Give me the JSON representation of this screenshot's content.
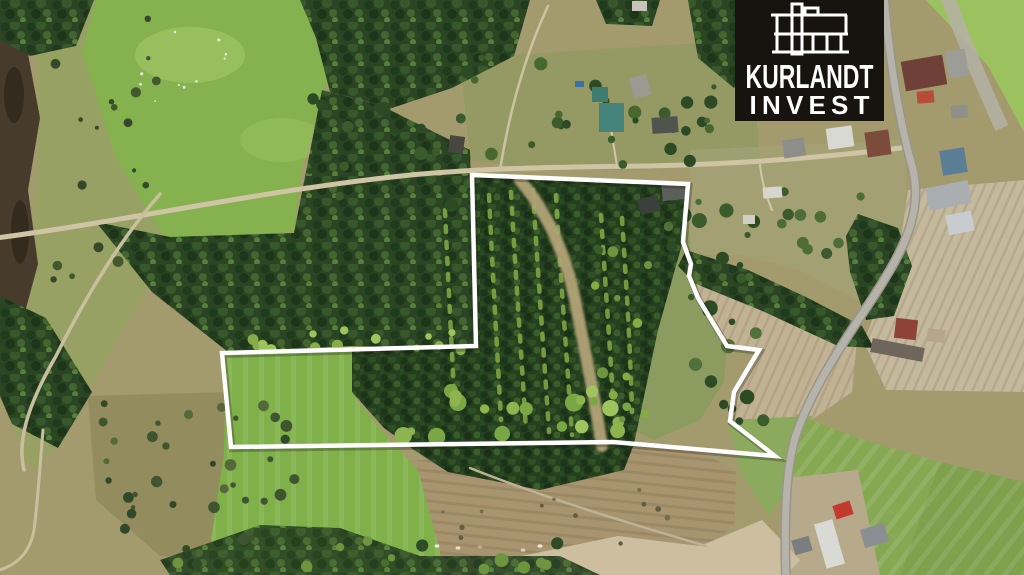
{
  "logo": {
    "brand_line1": "KURLANDT",
    "brand_line2": "INVEST",
    "bg": "#17140f",
    "fg": "#ffffff",
    "icon": "building-icon"
  },
  "boundary": {
    "color": "#ffffff",
    "stroke_width": 4.5,
    "points": "472,175 688,184 683,242 691,264 689,276 698,298 727,346 759,350 734,392 730,421 775,456 613,442 231,447 222,353 476,346"
  },
  "scene": {
    "colors": {
      "base_scrub": "#a39b6e",
      "marsh": "#98a164",
      "water": "#473c2b",
      "meadow": "#85b14e",
      "field_green_left": "#7fb04a",
      "field_green_right": "#87a853",
      "field_green_tr": "#9cc25f",
      "plow_beige": "#c4b89d",
      "plow_beige2": "#c1b294",
      "brown_field": "#a8956f",
      "beige_subfield": "#ccbe9f",
      "olive_meadow": "#8c9b5f",
      "grass_patch": "#8caa5e",
      "farm_yard": "#b7aa8a",
      "road_paved": "#b6b3ab",
      "road_paved_edge": "#999589",
      "road_dirt": "#cfc5a5",
      "clearing": "#b2a377",
      "forest_dark": "#2b4524",
      "plantation": "#25401e",
      "row_green": "#85ab45"
    },
    "roads": {
      "paved": "M884,-4 C889,55 897,112 912,166 C923,206 907,243 884,280 C858,323 818,374 797,432 C786,463 784,520 786,578",
      "dirt_main": "M-4,238 C120,222 250,193 392,177 C470,168 560,167 648,166 C740,164 830,157 908,147",
      "north_path": "M500,170 C508,120 522,62 548,6",
      "drive_teal": "M617,166 C613,142 610,122 607,104",
      "yard_path": "M760,165 C762,185 768,200 772,210",
      "forest_path": "M160,194 C118,242 84,300 56,356 C42,380 34,398 28,416 C22,436 20,452 24,470",
      "left_path": "M43,430 C40,465 38,500 34,530 C30,552 18,564 0,570",
      "field_path": "M470,468 C545,498 625,522 706,546",
      "clearing": "M520,180 C545,210 565,250 575,300 C583,340 595,400 602,446",
      "plow_band_tr": "M947,-4 C960,30 980,80 1002,128"
    },
    "houses": [
      {
        "x": 652,
        "y": 117,
        "w": 26,
        "h": 16,
        "r": -4,
        "f": "#4f544f"
      },
      {
        "x": 783,
        "y": 139,
        "w": 22,
        "h": 18,
        "r": -8,
        "f": "#8d8d89"
      },
      {
        "x": 827,
        "y": 127,
        "w": 26,
        "h": 21,
        "r": -8,
        "f": "#d9d9d4"
      },
      {
        "x": 866,
        "y": 131,
        "w": 24,
        "h": 25,
        "r": -8,
        "f": "#7b4b3b"
      },
      {
        "x": 903,
        "y": 58,
        "w": 42,
        "h": 30,
        "r": -10,
        "f": "#6e4038"
      },
      {
        "x": 947,
        "y": 50,
        "w": 20,
        "h": 27,
        "r": -10,
        "f": "#9d9d98"
      },
      {
        "x": 917,
        "y": 91,
        "w": 17,
        "h": 12,
        "r": -5,
        "f": "#b84c3b"
      },
      {
        "x": 951,
        "y": 105,
        "w": 17,
        "h": 13,
        "r": -5,
        "f": "#90908b"
      },
      {
        "x": 592,
        "y": 87,
        "w": 16,
        "h": 15,
        "r": 0,
        "f": "#3e7c70"
      },
      {
        "x": 599,
        "y": 103,
        "w": 25,
        "h": 29,
        "r": 0,
        "f": "#46837a"
      },
      {
        "x": 631,
        "y": 76,
        "w": 18,
        "h": 21,
        "r": -14,
        "f": "#9b9990"
      },
      {
        "x": 449,
        "y": 136,
        "w": 15,
        "h": 17,
        "r": 8,
        "f": "#474740"
      },
      {
        "x": 662,
        "y": 183,
        "w": 25,
        "h": 17,
        "r": -6,
        "f": "#5c5f59"
      },
      {
        "x": 639,
        "y": 197,
        "w": 20,
        "h": 16,
        "r": -14,
        "f": "#3c403a"
      },
      {
        "x": 763,
        "y": 187,
        "w": 19,
        "h": 11,
        "r": -4,
        "f": "#d6d6cd"
      },
      {
        "x": 743,
        "y": 215,
        "w": 12,
        "h": 9,
        "r": 0,
        "f": "#cfcfc5"
      },
      {
        "x": 927,
        "y": 184,
        "w": 43,
        "h": 23,
        "r": -11,
        "f": "#aaaeb1"
      },
      {
        "x": 947,
        "y": 213,
        "w": 26,
        "h": 20,
        "r": -11,
        "f": "#c9ccce"
      },
      {
        "x": 941,
        "y": 149,
        "w": 25,
        "h": 25,
        "r": -9,
        "f": "#5b7e95"
      },
      {
        "x": 895,
        "y": 319,
        "w": 22,
        "h": 20,
        "r": 7,
        "f": "#8e4238"
      },
      {
        "x": 871,
        "y": 343,
        "w": 53,
        "h": 14,
        "r": 11,
        "f": "#6e655c"
      },
      {
        "x": 927,
        "y": 329,
        "w": 18,
        "h": 13,
        "r": 7,
        "f": "#b6a68d"
      },
      {
        "x": 834,
        "y": 503,
        "w": 18,
        "h": 14,
        "r": -18,
        "f": "#c23a2e"
      },
      {
        "x": 820,
        "y": 521,
        "w": 19,
        "h": 46,
        "r": -16,
        "f": "#d9dad6"
      },
      {
        "x": 862,
        "y": 526,
        "w": 25,
        "h": 19,
        "r": -16,
        "f": "#8c8f91"
      },
      {
        "x": 793,
        "y": 538,
        "w": 18,
        "h": 15,
        "r": -16,
        "f": "#7b7e80"
      },
      {
        "x": 632,
        "y": 1,
        "w": 15,
        "h": 10,
        "r": 0,
        "f": "#c8c4b9"
      },
      {
        "x": 575,
        "y": 81,
        "w": 9,
        "h": 6,
        "r": 0,
        "f": "#3a6fb0"
      }
    ],
    "cattle": [
      {
        "x": 437,
        "y": 546,
        "f": "#efeade"
      },
      {
        "x": 458,
        "y": 548,
        "f": "#e8dcc8"
      },
      {
        "x": 480,
        "y": 547,
        "f": "#caa98a"
      },
      {
        "x": 523,
        "y": 550,
        "f": "#d9cdb6"
      },
      {
        "x": 540,
        "y": 546,
        "f": "#efeade"
      }
    ]
  }
}
